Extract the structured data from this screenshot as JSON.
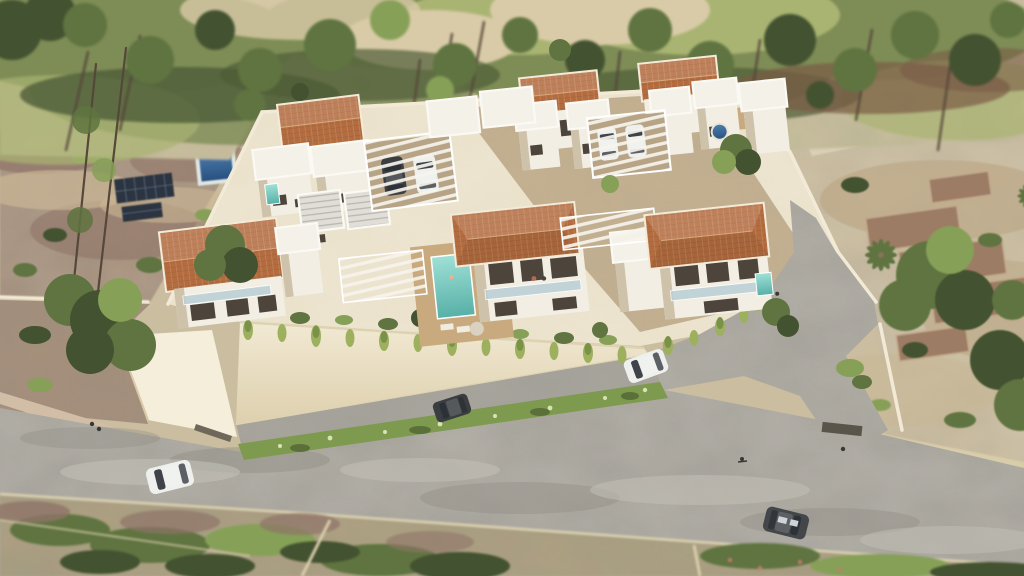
{
  "meta": {
    "type": "architectural-aerial-render",
    "description": "Aerial 3D architectural rendering of a walled residential development of white modern villas with terracotta pitched roofs, white flat-roof volumes, pergola carports with parked cars, a turquoise swimming pool with sun deck, a round plunge pool, cream retaining walls with cascading plants, an inner access road and a curved public road below, surrounded by tree-lined scrubland, a neighboring plot with a blue pool and solar panels to the west, and vacant terraced land with palms to the east."
  },
  "palette": {
    "sand": "#cbbd9f",
    "topsand": "#d0c3a2",
    "topgreen": "#7e8c56",
    "topgreen2": "#4e5c38",
    "palegrass": "#a9b472",
    "tree": "#5f7440",
    "tree2": "#435230",
    "tree3": "#86a058",
    "trunk": "#55473a",
    "nground": "#a8917c",
    "npurple": "#8f7468",
    "grass": "#7fa053",
    "solar": "#2b3440",
    "solargrid": "#5d6d84",
    "plot": "#eae1ca",
    "court": "#c4b191",
    "courtpad": "#b7a486",
    "wall": "#ece2c8",
    "wall2": "#f2ead6",
    "wallbright": "#f4eedb",
    "white": "#f2eee3",
    "shade": "#cfc2ab",
    "slab": "#f4f1e9",
    "window": "#4d453b",
    "glass": "#b9cfd6",
    "deck": "#c9aa7e",
    "road": "#a9a69e",
    "road2": "#c2bfb6",
    "curb": "#ddd3b2",
    "hedge": "#7e9a4f",
    "scrub": "#b2a083",
    "cardark": "#3b3e41",
    "carwhite": "#eef0ee",
    "stone": "#9c7c64",
    "stone2": "#c2a98c",
    "poolteal": "#57b0a7",
    "poolblue": "#2a5288"
  },
  "scene": {
    "development": {
      "villas": [
        {
          "id": "villa-nw",
          "roof": "terracotta-pitched-plus-flat-white-volumes",
          "storeys": 2,
          "features": [
            "plunge-pool"
          ]
        },
        {
          "id": "villa-nw-annex",
          "roof": "flat-with-solar-panels",
          "storeys": 1,
          "features": []
        },
        {
          "id": "villa-west",
          "roof": "terracotta-pitched",
          "storeys": 2,
          "features": [
            "balcony"
          ]
        },
        {
          "id": "villa-center",
          "roof": "terracotta-hipped",
          "storeys": 2,
          "features": [
            "swimming-pool",
            "sun-deck",
            "balcony",
            "pergola"
          ]
        },
        {
          "id": "villa-southeast",
          "roof": "terracotta-hipped",
          "storeys": 2,
          "features": [
            "plunge-pool",
            "balcony",
            "pergola"
          ]
        },
        {
          "id": "villa-ne-1",
          "roof": "terracotta-pitched-plus-flat-white-volumes",
          "storeys": 2,
          "features": []
        },
        {
          "id": "villa-ne-2",
          "roof": "terracotta-pitched-plus-flat-white-volumes",
          "storeys": 2,
          "features": [
            "round-plunge-pool",
            "patio"
          ]
        }
      ],
      "carports": [
        {
          "id": "carport-west",
          "type": "white-slat-pergola",
          "vehicles": [
            "dark-suv",
            "white-car"
          ]
        },
        {
          "id": "carport-east",
          "type": "white-slat-pergola",
          "vehicles": [
            "white-car",
            "white-car"
          ]
        }
      ],
      "pools": [
        {
          "id": "main-pool",
          "color": "turquoise",
          "extras": [
            "swimmer",
            "sun-loungers",
            "parasol"
          ]
        },
        {
          "id": "round-pool-ne",
          "color": "deep-blue"
        },
        {
          "id": "plunge-pool-nw",
          "color": "turquoise"
        },
        {
          "id": "plunge-pool-se",
          "color": "turquoise"
        }
      ],
      "retaining_wall": {
        "color": "cream",
        "feature": "cascading-plants-along-top-edge"
      },
      "courtyard": {
        "surface": "tan-paving",
        "access": "gate-to-inner-road-east"
      }
    },
    "roads": [
      {
        "id": "inner-access-road",
        "surface": "grey-asphalt",
        "vehicles": [
          "white-suv-moving",
          "dark-car-moving"
        ]
      },
      {
        "id": "south-road",
        "surface": "worn-grey-asphalt",
        "vehicles": [
          "white-pickup",
          "dark-sedan"
        ],
        "extras": [
          "green-median-hedge",
          "cream-curbs",
          "crossing-grate"
        ]
      }
    ],
    "surroundings": {
      "north": "dense tree line with slender trunks over green and sandy scrub",
      "west": "neighbouring plot with blue pool, ground solar array, lawn patch and parked car",
      "east": "vacant sandy lot with stone terrace ruins, palm trees and large green trees",
      "south": "scrubland lots with bushes and pale boundary walls"
    },
    "people": [
      "two pedestrians on south road sidewalk",
      "cyclist near road junction",
      "pedestrian at east crossing",
      "two figures on centre villa balcony",
      "swimmer in main pool",
      "figure on south-east villa terrace"
    ]
  }
}
